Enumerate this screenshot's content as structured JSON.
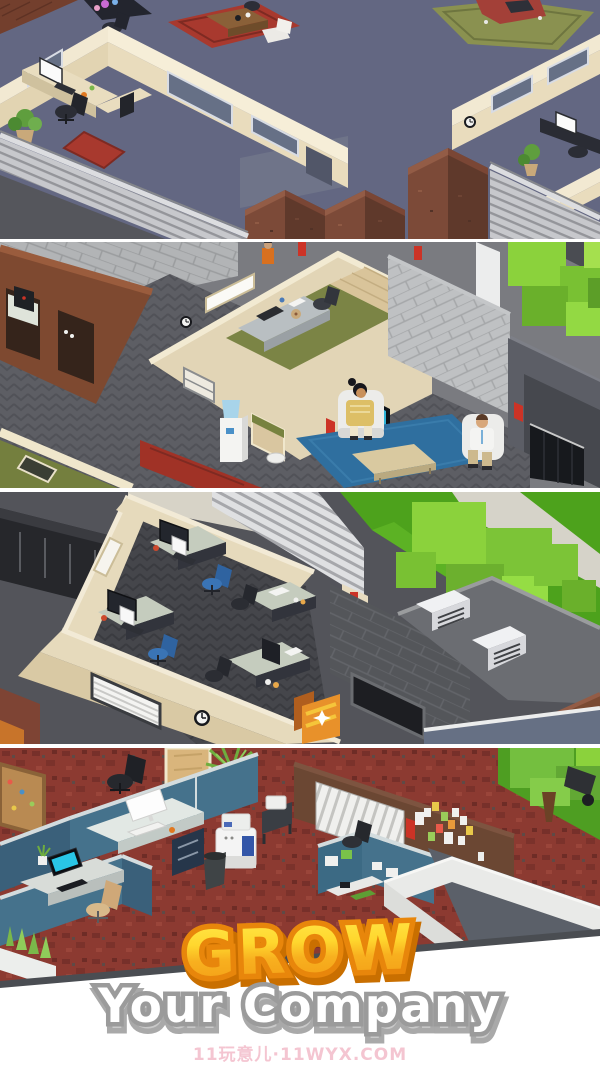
{
  "overlay": {
    "headline": "GROW",
    "subheadline": "Your Company",
    "watermark": "11玩意儿·11WYX.COM"
  },
  "palette": {
    "page_bg": "#ffffff",
    "headline_top": "#ffe84a",
    "headline_bottom": "#f29c15",
    "headline_outline": "#e8860b",
    "headline_shadow": "#c96f00",
    "subheadline_fill": "#ffffff",
    "subheadline_outline": "#9b9b9b",
    "subheadline_shadow": "#c9c9c9",
    "watermark": "#f3bcc9",
    "panel_divider": "#ffffff",
    "panel4_edge_line": "#4a4d52"
  },
  "panels": [
    {
      "id": "office-floor-cubicle-rooms"
    },
    {
      "id": "lounge-with-sofa-and-tv"
    },
    {
      "id": "open-office-desks-rooftop"
    },
    {
      "id": "cubicle-farm-red-carpet"
    }
  ]
}
